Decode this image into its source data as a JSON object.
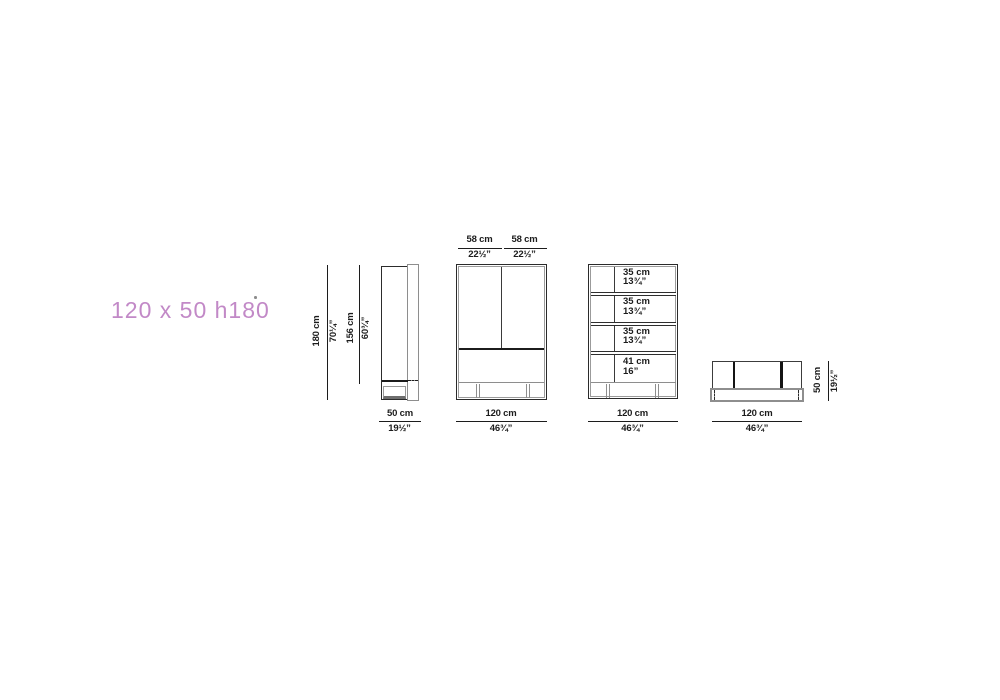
{
  "colors": {
    "accent": "#c289c7",
    "line": "#1c1c1c",
    "gray": "#8e8e8e"
  },
  "title_label": {
    "text": "120 x 50 h180"
  },
  "side_view": {
    "height_cm": "180 cm",
    "height_in": "70¼”",
    "interior_height_cm": "156 cm",
    "interior_height_in": "60¾”",
    "depth_cm": "50 cm",
    "depth_in": "19½”"
  },
  "door_view": {
    "left_door_cm": "58 cm",
    "left_door_in": "22½”",
    "right_door_cm": "58 cm",
    "right_door_in": "22½”",
    "width_cm": "120 cm",
    "width_in": "46¾”"
  },
  "shelf_view": {
    "shelves": [
      {
        "cm": "35 cm",
        "in": "13¾”"
      },
      {
        "cm": "35 cm",
        "in": "13¾”"
      },
      {
        "cm": "35 cm",
        "in": "13¾”"
      },
      {
        "cm": "41 cm",
        "in": "16”"
      }
    ],
    "width_cm": "120 cm",
    "width_in": "46¾”"
  },
  "top_view": {
    "depth_cm": "50 cm",
    "depth_in": "19½”",
    "width_cm": "120 cm",
    "width_in": "46¾”"
  }
}
